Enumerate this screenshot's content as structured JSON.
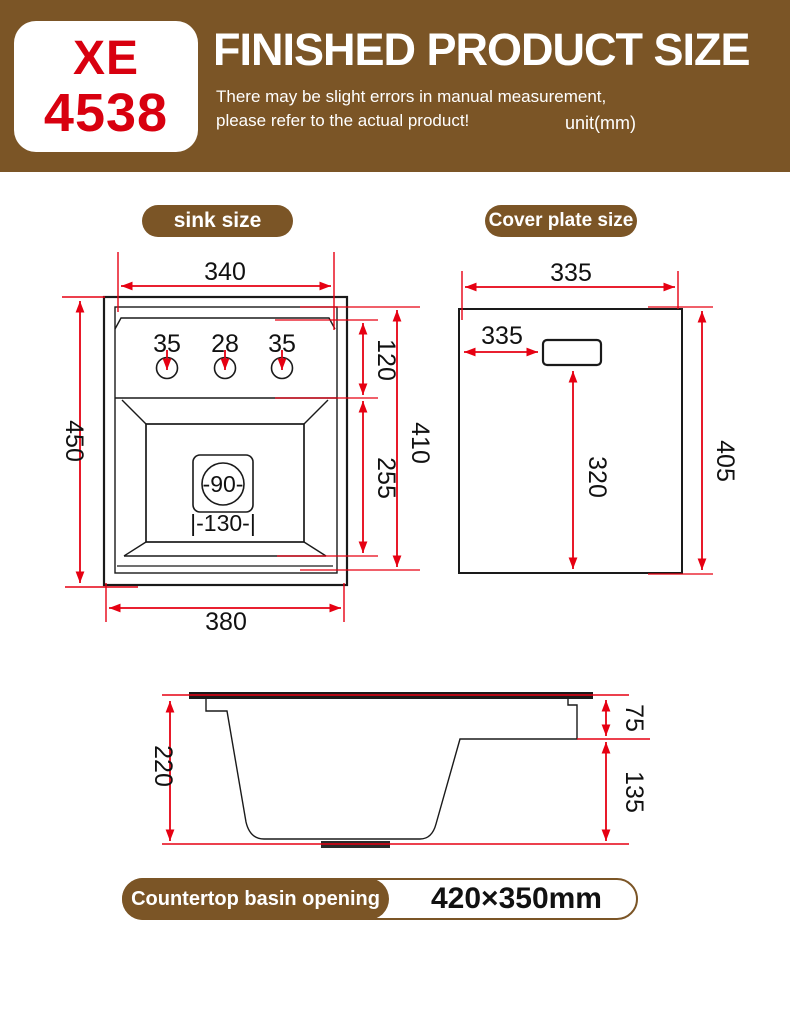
{
  "header": {
    "model_top": "XE",
    "model_bottom": "4538",
    "title": "FINISHED PRODUCT SIZE",
    "note1": "There may be slight errors in manual measurement,",
    "note2": "please refer to the actual product!",
    "unit": "unit(mm)"
  },
  "sections": {
    "sink": "sink size",
    "cover": "Cover plate size"
  },
  "sink_dims": {
    "top_width": "340",
    "height": "450",
    "bottom_width": "380",
    "hole1": "35",
    "hole2": "28",
    "hole3": "35",
    "deck_height": "120",
    "basin_height": "255",
    "inner_height": "410",
    "drain": "-90-",
    "drain_offset": "|-130-|"
  },
  "cover_dims": {
    "width": "335",
    "handle_offset": "335",
    "handle_to_bottom": "320",
    "height": "405"
  },
  "side_dims": {
    "depth": "220",
    "rim_drop": "75",
    "lower_drop": "135"
  },
  "footer": {
    "label": "Countertop basin opening",
    "value": "420×350mm"
  },
  "colors": {
    "brand_brown": "#7b5526",
    "dimension_red": "#e60012",
    "model_red": "#d8000f"
  }
}
